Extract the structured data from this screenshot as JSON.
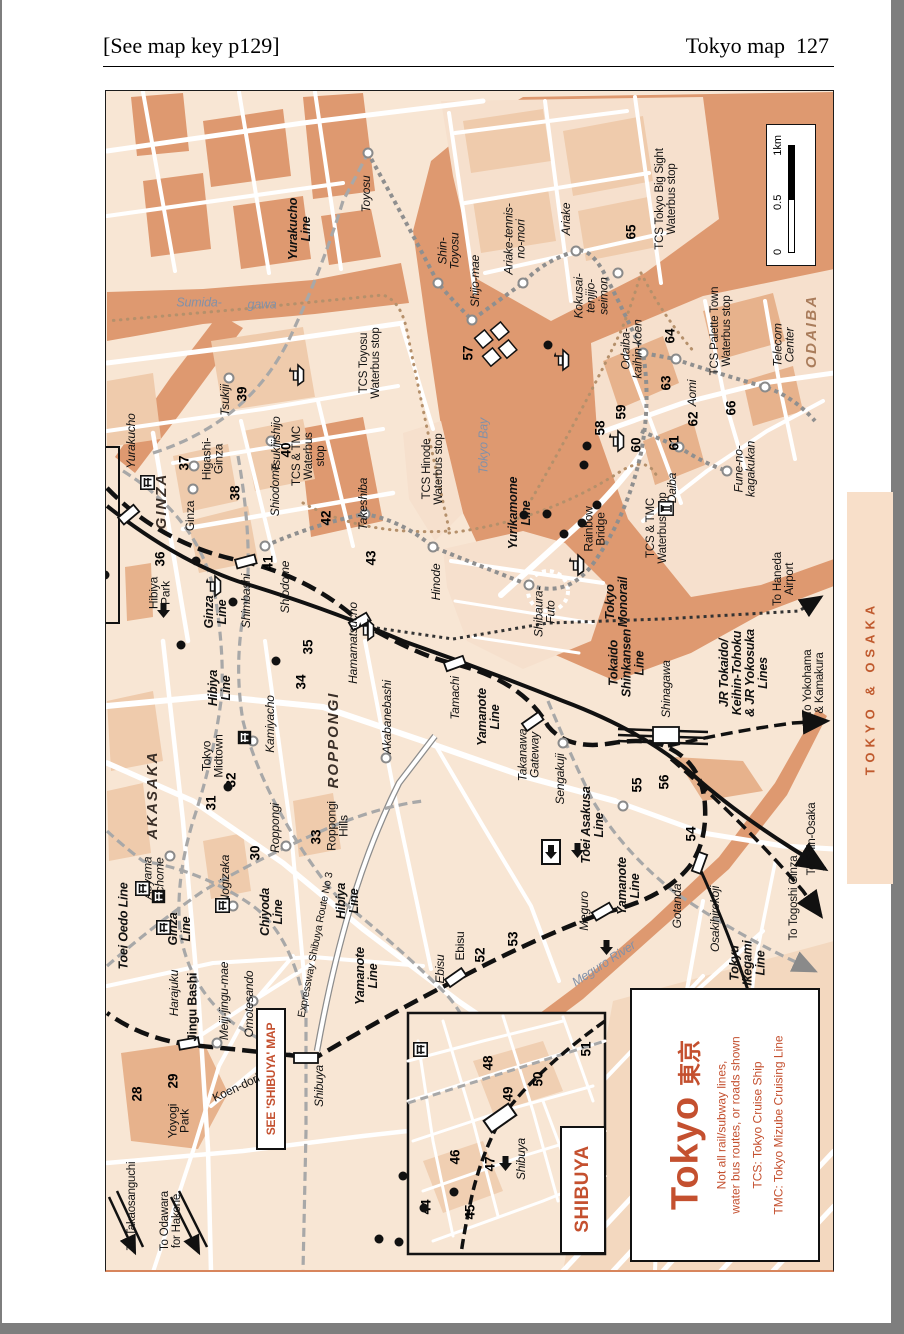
{
  "page": {
    "header_left": "[See map key p129]",
    "header_right": "Tokyo map",
    "page_number": "127"
  },
  "tab": {
    "label": "TOKYO & OSAKA"
  },
  "scale": {
    "t0": "0",
    "t05": "0.5",
    "t1": "1km"
  },
  "legend": {
    "title": "Tokyo",
    "title_jp": "東京",
    "note": "Not all rail/subway lines,\nwater bus routes, or roads shown",
    "tcs": "TCS: Tokyo Cruise Ship",
    "tmc": "TMC: Tokyo Mizube Cruising Line"
  },
  "colors": {
    "land": "#F8E6D4",
    "water": "#DE9970",
    "block": "#EFCBAC",
    "block_dark": "#E7B28C",
    "accent_red": "#C4502F",
    "tab_bg": "#F8DFC9",
    "tab_text": "#C05A2E"
  },
  "map": {
    "labels": [
      {
        "t": "Toyosu",
        "x": 363,
        "y": 193,
        "c": "stn"
      },
      {
        "t": "Shin-\nToyosu",
        "x": 446,
        "y": 250,
        "c": "stn"
      },
      {
        "t": "Shijo-mae",
        "x": 472,
        "y": 280,
        "c": "stn"
      },
      {
        "t": "Ariake-tennis-\nno-mori",
        "x": 512,
        "y": 238,
        "c": "stn"
      },
      {
        "t": "Ariake",
        "x": 563,
        "y": 218,
        "c": "stn"
      },
      {
        "t": "Kokusai-\ntenjijo-\nseimon",
        "x": 588,
        "y": 295,
        "c": "stn"
      },
      {
        "t": "Odaiba-\nkaihin-koen",
        "x": 629,
        "y": 348,
        "c": "stn"
      },
      {
        "t": "Aomi",
        "x": 689,
        "y": 392,
        "c": "stn"
      },
      {
        "t": "Telecom\nCenter",
        "x": 781,
        "y": 344,
        "c": "stn"
      },
      {
        "t": "Fune-no-\nkagakukan",
        "x": 742,
        "y": 468,
        "c": "stn"
      },
      {
        "t": "Daiba",
        "x": 669,
        "y": 487,
        "c": "stn"
      },
      {
        "t": "ODAIBA",
        "x": 809,
        "y": 330,
        "c": "bigbr"
      },
      {
        "t": "Tokyo Bay",
        "x": 481,
        "y": 445,
        "c": "water"
      },
      {
        "t": "Sumida-",
        "x": 196,
        "y": 302,
        "r": 0,
        "c": "water"
      },
      {
        "t": "gawa",
        "x": 259,
        "y": 304,
        "r": 0,
        "c": "water"
      },
      {
        "t": "Meguro River",
        "x": 601,
        "y": 963,
        "r": -33,
        "c": "water"
      },
      {
        "t": "Yurakucho\nLine",
        "x": 297,
        "y": 228,
        "c": "line"
      },
      {
        "t": "Yurikamome\nLine",
        "x": 517,
        "y": 512,
        "c": "line"
      },
      {
        "t": "Tokyo\nMonorail",
        "x": 614,
        "y": 601,
        "c": "line"
      },
      {
        "t": "Rainbow\nBridge",
        "x": 592,
        "y": 528,
        "c": "pl"
      },
      {
        "t": "TCS Toyosu\nWaterbus stop",
        "x": 368,
        "y": 362,
        "c": "stop"
      },
      {
        "t": "TCS & TMC\nWaterbus\nstop",
        "x": 307,
        "y": 455,
        "c": "stop"
      },
      {
        "t": "TCS Hinode\nWaterbus stop",
        "x": 431,
        "y": 468,
        "c": "stop"
      },
      {
        "t": "TCS & TMC\nWaterbus stop",
        "x": 655,
        "y": 527,
        "c": "stop"
      },
      {
        "t": "TCS Tokyo Big Sight\nWaterbus stop",
        "x": 664,
        "y": 198,
        "c": "stop"
      },
      {
        "t": "TCS Palette Town\nWaterbus stop",
        "x": 719,
        "y": 330,
        "c": "stop"
      },
      {
        "t": "Yurakucho",
        "x": 128,
        "y": 440,
        "c": "stn"
      },
      {
        "t": "GINZA",
        "x": 159,
        "y": 500,
        "c": "big"
      },
      {
        "t": "Ginza",
        "x": 187,
        "y": 515,
        "c": "pl"
      },
      {
        "t": "Higashi-\nGinza",
        "x": 210,
        "y": 458,
        "c": "pl"
      },
      {
        "t": "Tsukiji",
        "x": 222,
        "y": 399,
        "c": "stn"
      },
      {
        "t": "Tsukijishijo",
        "x": 273,
        "y": 443,
        "c": "stn"
      },
      {
        "t": "Shiodome",
        "x": 272,
        "y": 489,
        "c": "stn"
      },
      {
        "t": "Shiodome",
        "x": 282,
        "y": 586,
        "c": "stn"
      },
      {
        "t": "Takeshiba",
        "x": 360,
        "y": 503,
        "c": "stn"
      },
      {
        "t": "Hinode",
        "x": 433,
        "y": 581,
        "c": "stn"
      },
      {
        "t": "Shibaura-\nFuto",
        "x": 542,
        "y": 611,
        "c": "stn"
      },
      {
        "t": "Hibiya\nPark",
        "x": 157,
        "y": 592,
        "c": "pl"
      },
      {
        "t": "Shimbashi",
        "x": 243,
        "y": 600,
        "c": "stn"
      },
      {
        "t": "Ginza\nLine",
        "x": 213,
        "y": 611,
        "c": "line"
      },
      {
        "t": "Hibiya\nLine",
        "x": 217,
        "y": 687,
        "c": "line"
      },
      {
        "t": "Hamamatsucho",
        "x": 350,
        "y": 642,
        "c": "stn"
      },
      {
        "t": "Akabanebashi",
        "x": 384,
        "y": 716,
        "c": "stn"
      },
      {
        "t": "Kamiyacho",
        "x": 267,
        "y": 723,
        "c": "stn"
      },
      {
        "t": "Tamachi",
        "x": 452,
        "y": 697,
        "c": "stn"
      },
      {
        "t": "Yamanote\nLine",
        "x": 486,
        "y": 716,
        "c": "line"
      },
      {
        "t": "Takanawa\nGateway",
        "x": 526,
        "y": 754,
        "c": "stn"
      },
      {
        "t": "Sengakuji",
        "x": 557,
        "y": 778,
        "c": "stn"
      },
      {
        "t": "Shinagawa",
        "x": 663,
        "y": 688,
        "c": "stn"
      },
      {
        "t": "Tokaido\nShinkansen\nLine",
        "x": 624,
        "y": 662,
        "c": "line"
      },
      {
        "t": "JR Tokaido/\nKeihin-Tohoku\n& JR Yokosuka\nLines",
        "x": 741,
        "y": 672,
        "c": "line"
      },
      {
        "t": "To Haneda\nAirport",
        "x": 782,
        "y": 578,
        "c": "to"
      },
      {
        "t": "To Yokohama\n& Kamakura",
        "x": 812,
        "y": 682,
        "c": "to"
      },
      {
        "t": "To Shin-Osaka",
        "x": 810,
        "y": 838,
        "c": "to"
      },
      {
        "t": "To Togoshi Ginza",
        "x": 792,
        "y": 897,
        "c": "to"
      },
      {
        "t": "Toei Asakusa\nLine",
        "x": 590,
        "y": 824,
        "c": "line"
      },
      {
        "t": "Yamanote\nLine",
        "x": 626,
        "y": 885,
        "c": "line"
      },
      {
        "t": "Tokyu\nIkegami\nLine",
        "x": 745,
        "y": 962,
        "c": "line"
      },
      {
        "t": "Osakihirokoji",
        "x": 712,
        "y": 918,
        "c": "stn"
      },
      {
        "t": "Gotanda",
        "x": 674,
        "y": 905,
        "c": "stn"
      },
      {
        "t": "Meguro",
        "x": 581,
        "y": 910,
        "c": "stn"
      },
      {
        "t": "Ebisu",
        "x": 437,
        "y": 968,
        "c": "stn"
      },
      {
        "t": "Ebisu",
        "x": 457,
        "y": 945,
        "c": "pl"
      },
      {
        "t": "AKASAKA",
        "x": 150,
        "y": 794,
        "c": "big"
      },
      {
        "t": "Tokyo\nMidtown",
        "x": 210,
        "y": 755,
        "c": "pl"
      },
      {
        "t": "ROPPONGI",
        "x": 331,
        "y": 739,
        "c": "big"
      },
      {
        "t": "Roppongi",
        "x": 272,
        "y": 827,
        "c": "stn"
      },
      {
        "t": "Roppongi\nHills",
        "x": 335,
        "y": 825,
        "c": "pl"
      },
      {
        "t": "Nogizaka",
        "x": 222,
        "y": 878,
        "c": "stn"
      },
      {
        "t": "Aoyama\nItchome",
        "x": 151,
        "y": 877,
        "c": "stn"
      },
      {
        "t": "Toei Oedo Line",
        "x": 121,
        "y": 925,
        "c": "line"
      },
      {
        "t": "Ginza\nLine",
        "x": 177,
        "y": 928,
        "c": "line"
      },
      {
        "t": "Chiyoda\nLine",
        "x": 269,
        "y": 911,
        "c": "line"
      },
      {
        "t": "Hibiya\nLine",
        "x": 345,
        "y": 900,
        "c": "line"
      },
      {
        "t": "Expressway Shibuya Route No 3",
        "x": 313,
        "y": 944,
        "r": -79,
        "c": "exp"
      },
      {
        "t": "Yamanote\nLine",
        "x": 364,
        "y": 975,
        "c": "line"
      },
      {
        "t": "Harajuku",
        "x": 171,
        "y": 992,
        "c": "stn"
      },
      {
        "t": "Jingu Bashi",
        "x": 190,
        "y": 1006,
        "c": "plb"
      },
      {
        "t": "Meiji-jingu-mae",
        "x": 221,
        "y": 1000,
        "c": "stn"
      },
      {
        "t": "Omotesando",
        "x": 246,
        "y": 1003,
        "c": "stn"
      },
      {
        "t": "Koen-dori",
        "x": 233,
        "y": 1087,
        "r": -25,
        "c": "pl"
      },
      {
        "t": "Yoyogi\nPark",
        "x": 176,
        "y": 1120,
        "c": "pl"
      },
      {
        "t": "SEE 'SHIBUYA' MAP",
        "x": 268,
        "y": 1078,
        "c": "red"
      },
      {
        "t": "Shibuya",
        "x": 316,
        "y": 1085,
        "c": "stn"
      },
      {
        "t": "To Takaosanguchi",
        "x": 130,
        "y": 1205,
        "c": "to"
      },
      {
        "t": "To Odawara\nfor Hakone",
        "x": 169,
        "y": 1220,
        "c": "to"
      },
      {
        "t": "Shibuya",
        "x": 518,
        "y": 1158,
        "c": "stn"
      },
      {
        "t": "SHIBUYA",
        "x": 580,
        "y": 1188,
        "c": "bigred"
      }
    ],
    "markers": [
      {
        "n": "28",
        "x": 134,
        "y": 1093,
        "icon": "torii",
        "ix": 141,
        "iy": 1071
      },
      {
        "n": "29",
        "x": 170,
        "y": 1080,
        "icon": "dot",
        "ix": 158,
        "iy": 1070
      },
      {
        "n": "30",
        "x": 252,
        "y": 852,
        "icon": "gate",
        "ix": 243,
        "iy": 831
      },
      {
        "n": "31",
        "x": 208,
        "y": 802,
        "icon": "gate",
        "ix": 222,
        "iy": 792
      },
      {
        "n": "32",
        "x": 228,
        "y": 779,
        "icon": "shrineB",
        "ix": 238,
        "iy": 800
      },
      {
        "n": "33",
        "x": 313,
        "y": 836,
        "icon": "gate",
        "ix": 302,
        "iy": 809
      },
      {
        "n": "34",
        "x": 298,
        "y": 681,
        "icon": "dot",
        "ix": 309,
        "iy": 689
      },
      {
        "n": "35",
        "x": 305,
        "y": 646,
        "icon": "shrineB",
        "ix": 324,
        "iy": 641
      },
      {
        "n": "36",
        "x": 157,
        "y": 558,
        "icon": "bldg",
        "ix": 143,
        "iy": 539
      },
      {
        "n": "37",
        "x": 181,
        "y": 462,
        "icon": "dot",
        "ix": 186,
        "iy": 477
      },
      {
        "n": "38",
        "x": 232,
        "y": 492,
        "icon": "bldg",
        "ix": 243,
        "iy": 515
      },
      {
        "n": "39",
        "x": 239,
        "y": 393,
        "icon": "gate",
        "ix": 227,
        "iy": 386
      },
      {
        "n": "40",
        "x": 283,
        "y": 449,
        "icon": "dot",
        "ix": 277,
        "iy": 463
      },
      {
        "n": "41",
        "x": 265,
        "y": 562,
        "icon": "dot",
        "ix": 262,
        "iy": 547
      },
      {
        "n": "42",
        "x": 323,
        "y": 517,
        "icon": "dot",
        "ix": 314,
        "iy": 504
      },
      {
        "n": "43",
        "x": 368,
        "y": 557,
        "icon": "dot",
        "ix": 357,
        "iy": 563
      },
      {
        "n": "44",
        "x": 423,
        "y": 1206,
        "icon": "open",
        "ix": 421,
        "iy": 1226
      },
      {
        "n": "45",
        "x": 467,
        "y": 1211,
        "icon": "dot",
        "ix": 468,
        "iy": 1190
      },
      {
        "n": "46",
        "x": 452,
        "y": 1156,
        "icon": "dot",
        "ix": 460,
        "iy": 1141
      },
      {
        "n": "47",
        "x": 487,
        "y": 1163,
        "icon": "dot",
        "ix": 480,
        "iy": 1144
      },
      {
        "n": "48",
        "x": 485,
        "y": 1062,
        "icon": "dot",
        "ix": 484,
        "iy": 1078
      },
      {
        "n": "49",
        "x": 505,
        "y": 1093,
        "icon": "dot",
        "ix": 505,
        "iy": 1110
      },
      {
        "n": "50",
        "x": 535,
        "y": 1078,
        "icon": "dot",
        "ix": 535,
        "iy": 1094
      },
      {
        "n": "51",
        "x": 583,
        "y": 1048,
        "icon": "bldg",
        "ix": 585,
        "iy": 1068
      },
      {
        "n": "52",
        "x": 477,
        "y": 954,
        "icon": "none",
        "ix": 0,
        "iy": 0
      },
      {
        "n": "53",
        "x": 510,
        "y": 938,
        "icon": "gate",
        "ix": 500,
        "iy": 953
      },
      {
        "n": "54",
        "x": 688,
        "y": 833,
        "icon": "bldg",
        "ix": 686,
        "iy": 852
      },
      {
        "n": "55",
        "x": 634,
        "y": 784,
        "icon": "bldgW",
        "ix": 628,
        "iy": 761
      },
      {
        "n": "56",
        "x": 661,
        "y": 781,
        "icon": "bldg",
        "ix": 657,
        "iy": 755
      },
      {
        "n": "57",
        "x": 465,
        "y": 352,
        "icon": "none",
        "ix": 0,
        "iy": 0
      },
      {
        "n": "58",
        "x": 597,
        "y": 427,
        "icon": "dot",
        "ix": 605,
        "iy": 417
      },
      {
        "n": "59",
        "x": 618,
        "y": 411,
        "icon": "dot",
        "ix": 628,
        "iy": 416
      },
      {
        "n": "60",
        "x": 633,
        "y": 444,
        "icon": "dot",
        "ix": 645,
        "iy": 436
      },
      {
        "n": "61",
        "x": 671,
        "y": 442,
        "icon": "dot",
        "ix": 663,
        "iy": 425
      },
      {
        "n": "62",
        "x": 690,
        "y": 418,
        "icon": "dot",
        "ix": 678,
        "iy": 407
      },
      {
        "n": "63",
        "x": 663,
        "y": 382,
        "icon": "dot",
        "ix": 665,
        "iy": 367
      },
      {
        "n": "64",
        "x": 667,
        "y": 335,
        "icon": "dot",
        "ix": 668,
        "iy": 348
      },
      {
        "n": "65",
        "x": 628,
        "y": 231,
        "icon": "dot",
        "ix": 629,
        "iy": 247
      },
      {
        "n": "66",
        "x": 728,
        "y": 407,
        "icon": "column",
        "ix": 745,
        "iy": 412
      }
    ],
    "ferries": [
      {
        "x": 375,
        "y": 283
      },
      {
        "x": 292,
        "y": 494
      },
      {
        "x": 445,
        "y": 538
      },
      {
        "x": 655,
        "y": 473
      },
      {
        "x": 640,
        "y": 268
      },
      {
        "x": 695,
        "y": 349
      }
    ]
  }
}
